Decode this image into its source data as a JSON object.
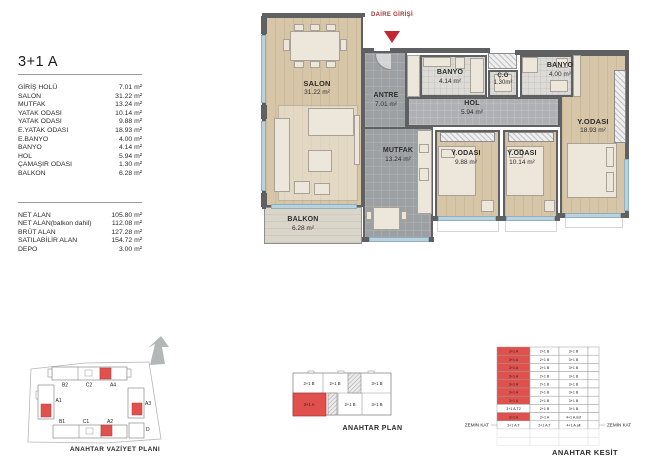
{
  "unit_info": {
    "title": "3+1 A",
    "rooms": [
      {
        "label": "GİRİŞ HOLÜ",
        "value": "7.01 m²"
      },
      {
        "label": "SALON",
        "value": "31.22 m²"
      },
      {
        "label": "MUTFAK",
        "value": "13.24 m²"
      },
      {
        "label": "YATAK ODASI",
        "value": "10.14 m²"
      },
      {
        "label": "YATAK ODASI",
        "value": "9.88 m²"
      },
      {
        "label": "E.YATAK ODASI",
        "value": "18.93 m²"
      },
      {
        "label": "E.BANYO",
        "value": "4.00 m²"
      },
      {
        "label": "BANYO",
        "value": "4.14 m²"
      },
      {
        "label": "HOL",
        "value": "5.94 m²"
      },
      {
        "label": "ÇAMAŞIR ODASI",
        "value": "1.30 m²"
      },
      {
        "label": "BALKON",
        "value": "6.28 m²"
      }
    ],
    "summary": [
      {
        "label": "NET ALAN",
        "value": "105.80 m²"
      },
      {
        "label": "NET ALAN(balkon dahil)",
        "value": "112.08 m²"
      },
      {
        "label": "BRÜT ALAN",
        "value": "127.28 m²"
      },
      {
        "label": "SATILABİLİR ALAN",
        "value": "154.72 m²"
      },
      {
        "label": "DEPO",
        "value": "3.00 m²"
      }
    ]
  },
  "floorplan": {
    "entrance_label": "DAİRE GİRİŞİ",
    "rooms": {
      "salon": {
        "name": "SALON",
        "area": "31.22 m²"
      },
      "antre": {
        "name": "ANTRE",
        "area": "7.01 m²"
      },
      "mutfak": {
        "name": "MUTFAK",
        "area": "13.24 m²"
      },
      "banyo1": {
        "name": "BANYO",
        "area": "4.14 m²"
      },
      "co": {
        "name": "Ç.O",
        "area": "1.30m²"
      },
      "banyo2": {
        "name": "BANYO",
        "area": "4.00 m²"
      },
      "hol": {
        "name": "HOL",
        "area": "5.94 m²"
      },
      "yodasi1": {
        "name": "Y.ODASI",
        "area": "9.88 m²"
      },
      "yodasi2": {
        "name": "Y.ODASI",
        "area": "10.14 m²"
      },
      "eyodasi": {
        "name": "Y.ODASI",
        "area": "18.93 m²"
      },
      "balkon": {
        "name": "BALKON",
        "area": "6.28 m²"
      }
    }
  },
  "site_plan": {
    "title": "ANAHTAR VAZİYET PLANI",
    "blocks": [
      "B2",
      "C2",
      "A4",
      "A1",
      "A3",
      "B1",
      "C1",
      "A2",
      "D"
    ]
  },
  "key_plan": {
    "title": "ANAHTAR PLAN",
    "top_row": [
      "2+1 B",
      "2+1 B",
      "3+1 B"
    ],
    "bottom_row": [
      "3+1 A",
      "2+1 B",
      "3+1 B"
    ]
  },
  "key_section": {
    "title": "ANAHTAR KESİT",
    "left_label": "ZEMİN KAT",
    "right_label": "ZEMİN KAT",
    "rows": [
      {
        "cells": [
          "3+1 A",
          "2+1 B",
          "3+1 B"
        ],
        "red": true
      },
      {
        "cells": [
          "3+1 A",
          "2+1 B",
          "3+1 B"
        ],
        "red": true
      },
      {
        "cells": [
          "3+1 A",
          "2+1 B",
          "3+1 B"
        ],
        "red": true
      },
      {
        "cells": [
          "3+1 A",
          "2+1 B",
          "3+1 B"
        ],
        "red": true
      },
      {
        "cells": [
          "3+1 A",
          "2+1 B",
          "3+1 B"
        ],
        "red": true
      },
      {
        "cells": [
          "3+1 A",
          "2+1 B",
          "3+1 B"
        ],
        "red": true
      },
      {
        "cells": [
          "3+1 A",
          "2+1 B",
          "3+1 B"
        ],
        "red": true
      },
      {
        "cells": [
          "3+1 A.T2",
          "2+1 B",
          "3+1 B"
        ],
        "red": false
      },
      {
        "cells": [
          "3+1 A",
          "2+1 A",
          "4+1 A.üst"
        ],
        "red": true
      },
      {
        "cells": [
          "3+1 A.T",
          "2+1 A.T",
          "4+1 A.alt"
        ],
        "red": false
      }
    ]
  },
  "colors": {
    "highlight": "#e0514d",
    "arrow_red": "#c22733",
    "window_blue": "#b9d2de",
    "wood_floor": "#d6c5a7",
    "gray_floor": "#9da0a3"
  }
}
